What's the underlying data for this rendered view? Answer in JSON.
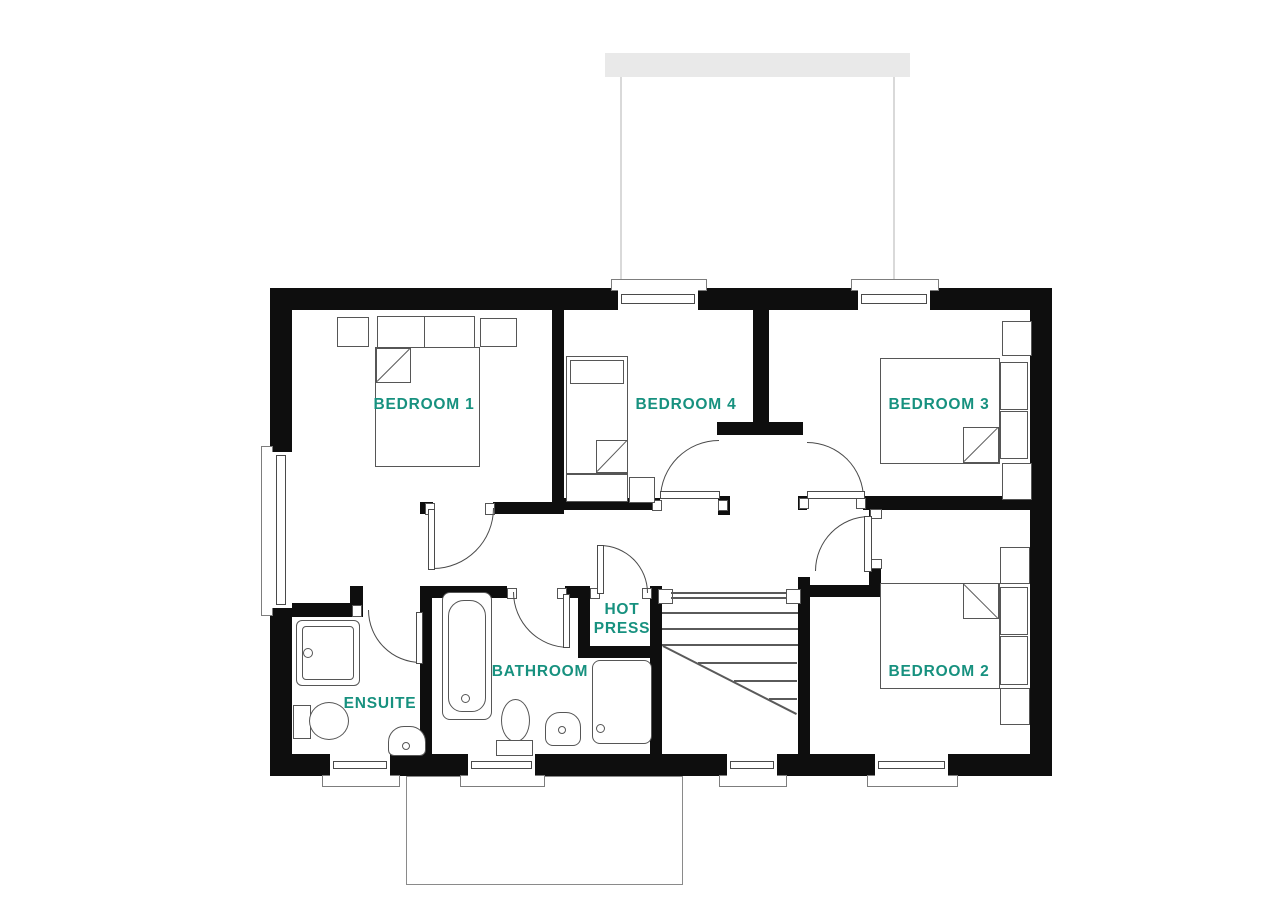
{
  "title": "First floor plan",
  "palette": {
    "label_teal": "#17917f",
    "wall_black": "#0e0e0e",
    "canopy_gray": "#e9e9e9"
  },
  "rooms": {
    "bedroom1": {
      "label": "BEDROOM 1"
    },
    "bedroom2": {
      "label": "BEDROOM 2"
    },
    "bedroom3": {
      "label": "BEDROOM 3"
    },
    "bedroom4": {
      "label": "BEDROOM 4"
    },
    "ensuite": {
      "label": "ENSUITE"
    },
    "bathroom": {
      "label": "BATHROOM"
    },
    "hot_press": {
      "label_line1": "HOT",
      "label_line2": "PRESS"
    }
  }
}
